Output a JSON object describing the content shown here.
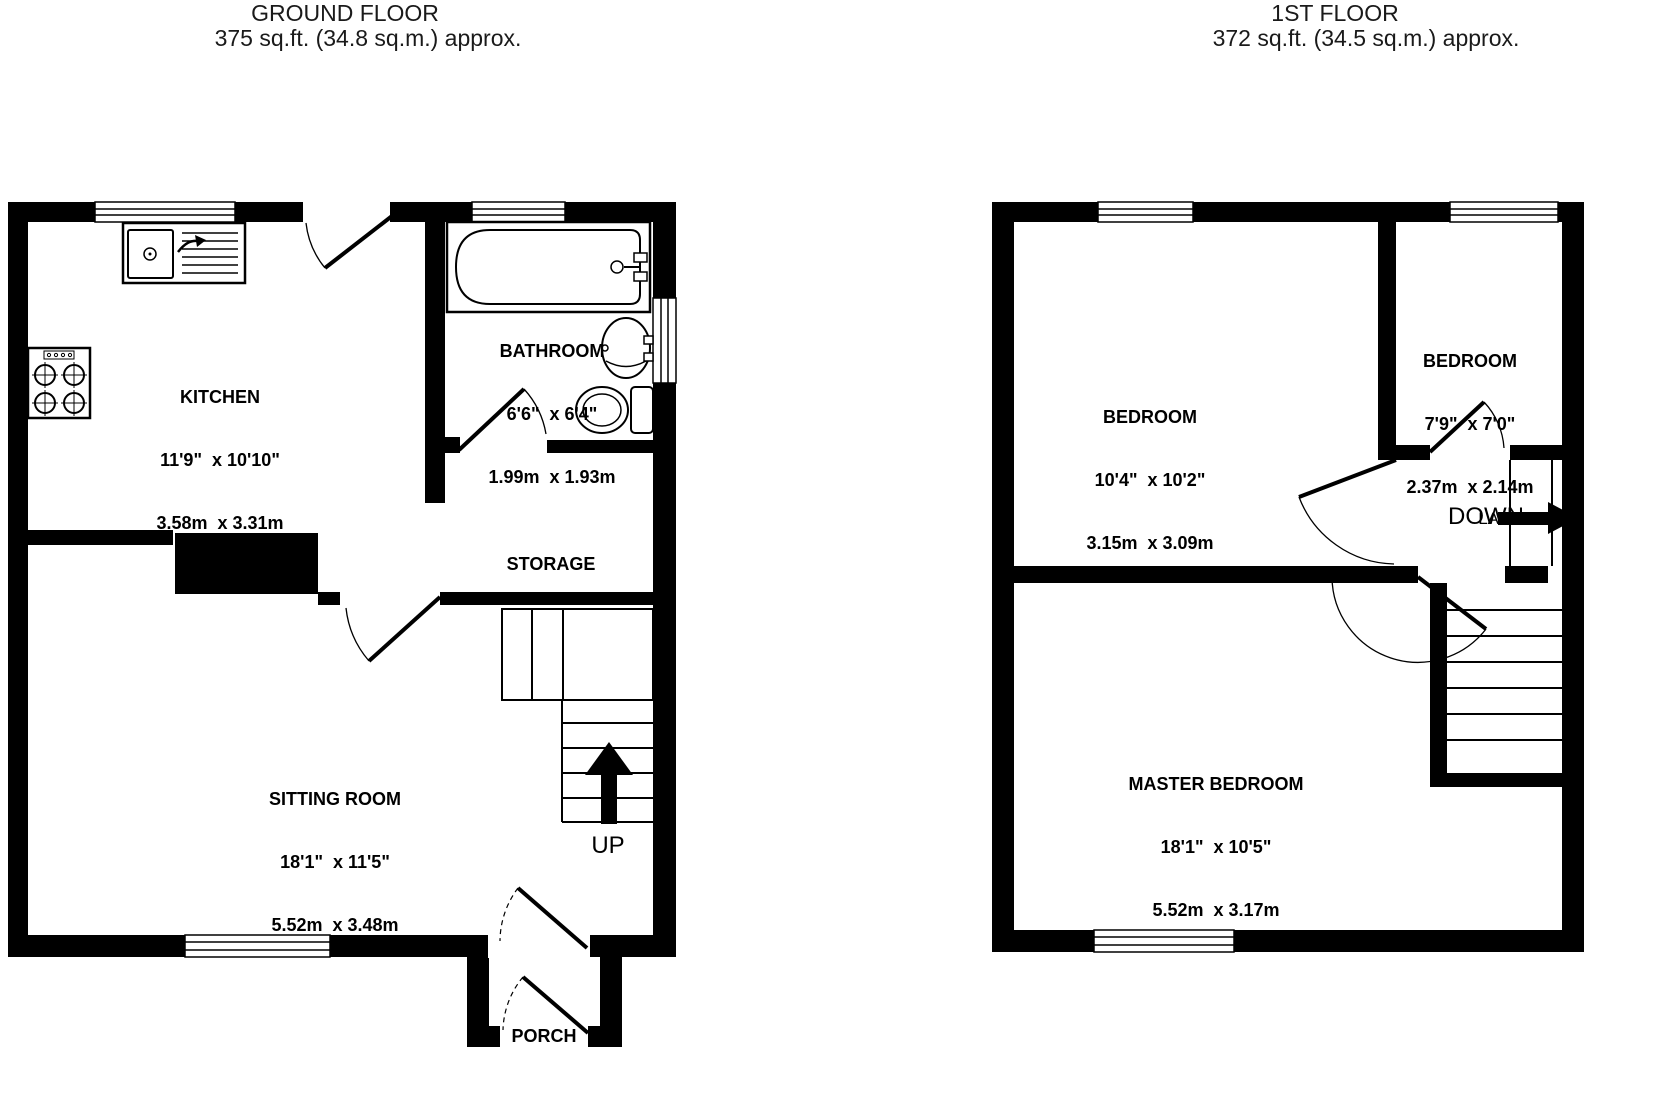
{
  "ground": {
    "title": "GROUND FLOOR",
    "subtitle": "375 sq.ft. (34.8 sq.m.) approx.",
    "rooms": {
      "kitchen": {
        "name": "KITCHEN",
        "imperial": "11'9\"  x 10'10\"",
        "metric": "3.58m  x 3.31m"
      },
      "bathroom": {
        "name": "BATHROOM",
        "imperial": "6'6\"  x 6'4\"",
        "metric": "1.99m  x 1.93m"
      },
      "sitting_room": {
        "name": "SITTING ROOM",
        "imperial": "18'1\"  x 11'5\"",
        "metric": "5.52m  x 3.48m"
      },
      "storage": {
        "name": "STORAGE"
      },
      "porch": {
        "name": "PORCH"
      }
    },
    "stair_label": "UP"
  },
  "first": {
    "title": "1ST FLOOR",
    "subtitle": "372 sq.ft. (34.5 sq.m.) approx.",
    "rooms": {
      "bedroom_front": {
        "name": "BEDROOM",
        "imperial": "10'4\"  x 10'2\"",
        "metric": "3.15m  x 3.09m"
      },
      "bedroom_small": {
        "name": "BEDROOM",
        "imperial": "7'9\"  x 7'0\"",
        "metric": "2.37m  x 2.14m"
      },
      "master": {
        "name": "MASTER BEDROOM",
        "imperial": "18'1\"  x 10'5\"",
        "metric": "5.52m  x 3.17m"
      },
      "landing": {
        "name": "LANDING"
      }
    },
    "stair_label": "DOWN"
  },
  "colors": {
    "ink": "#000000",
    "paper": "#ffffff"
  }
}
